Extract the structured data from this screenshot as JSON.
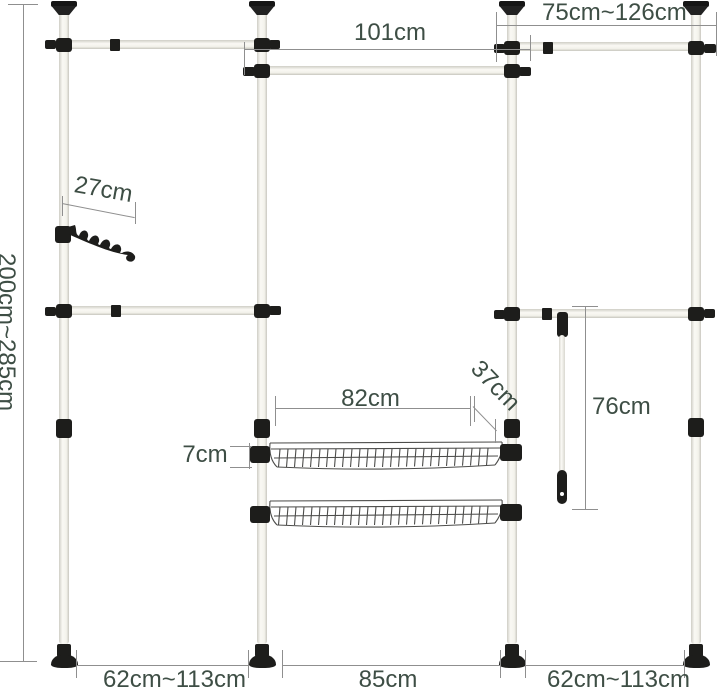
{
  "diagram": {
    "description": "adjustable telescopic wardrobe clothes rack dimension diagram",
    "labels": {
      "height": "200cm~285cm",
      "top_middle_width": "101cm",
      "top_right_width": "75cm~126cm",
      "hook_length": "27cm",
      "basket_width": "82cm",
      "basket_depth": "37cm",
      "basket_height": "7cm",
      "hanging_rod_length": "76cm",
      "bottom_left_width": "62cm~113cm",
      "bottom_middle_width": "85cm",
      "bottom_right_width": "62cm~113cm"
    },
    "colors": {
      "label_text": "#3e4e45",
      "dimension_line": "#8f8f8f",
      "fitting_black": "#1d1d1b",
      "pole_fill": "#f6f5f0",
      "background": "#ffffff"
    }
  }
}
